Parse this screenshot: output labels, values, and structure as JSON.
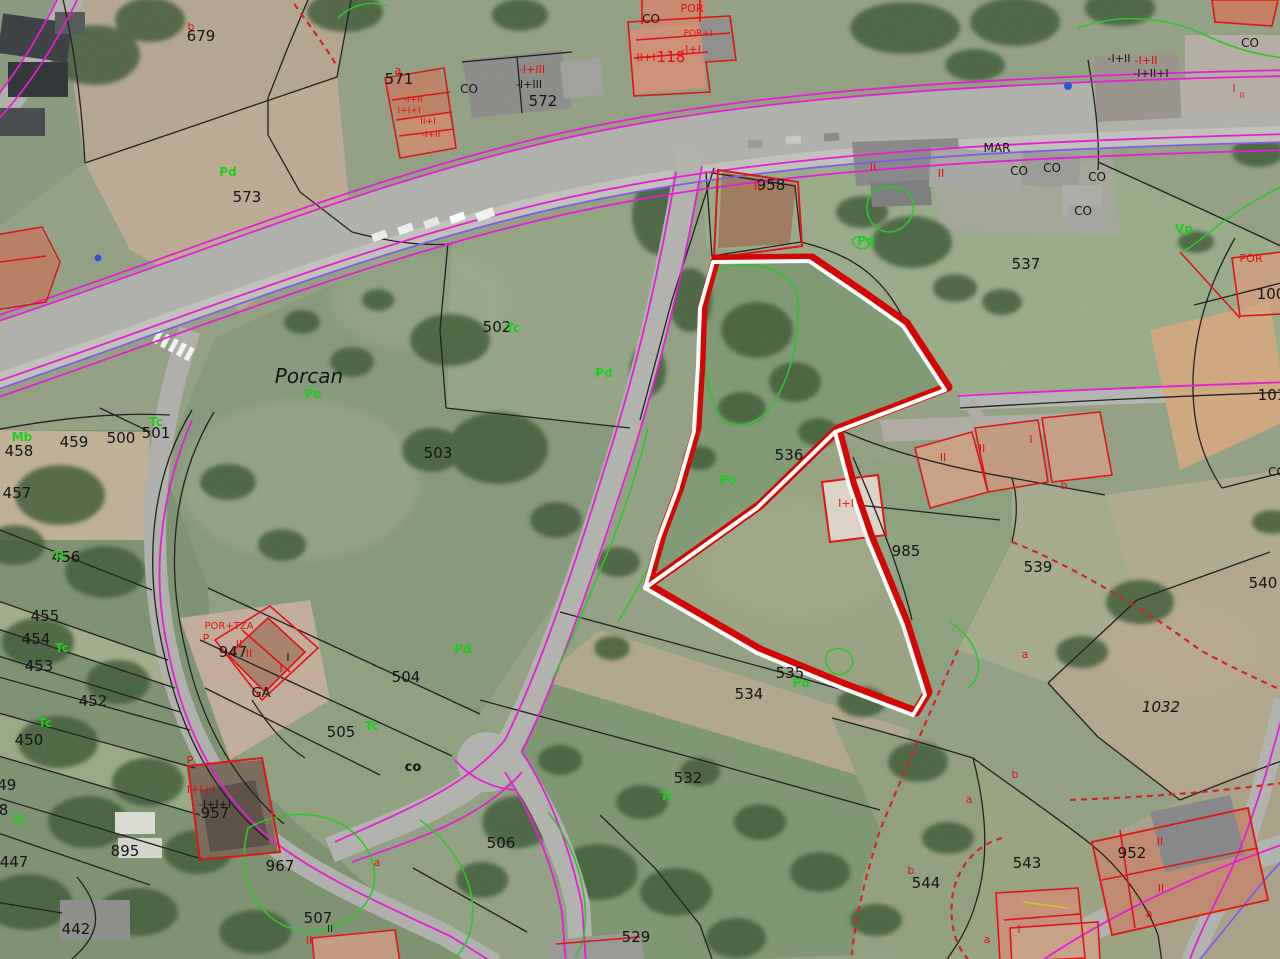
{
  "map": {
    "type": "cadastral-parcel-viewer-over-aerial-imagery",
    "place_name": "Porcan",
    "colors": {
      "parcel_boundary_black": "#1c1c1c",
      "road_edge_magenta": "#e619d6",
      "utility_purple": "#7b5be8",
      "vegetation_green": "#22cc22",
      "building_outline_red": "#e01010",
      "selection_red": "#d40000",
      "selection_white": "#ffffff"
    },
    "selection": {
      "outline": "#d40000",
      "inner_line": "#ffffff",
      "style": "thick red band with white stripe"
    },
    "labels": {
      "parcels": {
        "fill": "#141414",
        "size": 15,
        "items": [
          {
            "t": "679",
            "x": 201,
            "y": 41
          },
          {
            "t": "573",
            "x": 247,
            "y": 202
          },
          {
            "t": "571",
            "x": 399,
            "y": 84
          },
          {
            "t": "572",
            "x": 543,
            "y": 106
          },
          {
            "t": "958",
            "x": 771,
            "y": 190
          },
          {
            "t": "537",
            "x": 1026,
            "y": 269
          },
          {
            "t": "502",
            "x": 497,
            "y": 332
          },
          {
            "t": "503",
            "x": 438,
            "y": 458
          },
          {
            "t": "459",
            "x": 74,
            "y": 447
          },
          {
            "t": "458",
            "x": 19,
            "y": 456
          },
          {
            "t": "500",
            "x": 121,
            "y": 443
          },
          {
            "t": "501",
            "x": 156,
            "y": 438
          },
          {
            "t": "457",
            "x": 17,
            "y": 498
          },
          {
            "t": "456",
            "x": 66,
            "y": 562
          },
          {
            "t": "455",
            "x": 45,
            "y": 621
          },
          {
            "t": "454",
            "x": 36,
            "y": 644
          },
          {
            "t": "453",
            "x": 39,
            "y": 671
          },
          {
            "t": "452",
            "x": 93,
            "y": 706
          },
          {
            "t": "450",
            "x": 29,
            "y": 745
          },
          {
            "t": "449",
            "x": 2,
            "y": 790
          },
          {
            "t": "448",
            "x": -6,
            "y": 815
          },
          {
            "t": "447",
            "x": 14,
            "y": 867
          },
          {
            "t": "442",
            "x": 76,
            "y": 934
          },
          {
            "t": "947",
            "x": 233,
            "y": 657
          },
          {
            "t": "895",
            "x": 125,
            "y": 856
          },
          {
            "t": "957",
            "x": 215,
            "y": 818
          },
          {
            "t": "967",
            "x": 280,
            "y": 871
          },
          {
            "t": "504",
            "x": 406,
            "y": 682
          },
          {
            "t": "505",
            "x": 341,
            "y": 737
          },
          {
            "t": "506",
            "x": 501,
            "y": 848
          },
          {
            "t": "507",
            "x": 318,
            "y": 923
          },
          {
            "t": "529",
            "x": 636,
            "y": 942
          },
          {
            "t": "532",
            "x": 688,
            "y": 783
          },
          {
            "t": "534",
            "x": 749,
            "y": 699
          },
          {
            "t": "535",
            "x": 790,
            "y": 678
          },
          {
            "t": "536",
            "x": 789,
            "y": 460
          },
          {
            "t": "985",
            "x": 906,
            "y": 556
          },
          {
            "t": "539",
            "x": 1038,
            "y": 572
          },
          {
            "t": "540",
            "x": 1263,
            "y": 588
          },
          {
            "t": "1032",
            "x": 1161,
            "y": 712,
            "it": true
          },
          {
            "t": "543",
            "x": 1027,
            "y": 868
          },
          {
            "t": "544",
            "x": 926,
            "y": 888
          },
          {
            "t": "952",
            "x": 1132,
            "y": 858
          },
          {
            "t": "100",
            "x": 1271,
            "y": 299
          },
          {
            "t": "101",
            "x": 1272,
            "y": 400
          }
        ]
      },
      "codes_black": {
        "fill": "#141414",
        "size": 12,
        "items": [
          {
            "t": "Porcan",
            "x": 309,
            "y": 383,
            "fs": 20,
            "it": true
          },
          {
            "t": "MAR",
            "x": 997,
            "y": 152
          },
          {
            "t": "CO",
            "x": 469,
            "y": 93
          },
          {
            "t": "CO",
            "x": 651,
            "y": 23
          },
          {
            "t": "CO",
            "x": 1019,
            "y": 175
          },
          {
            "t": "CO",
            "x": 1052,
            "y": 172
          },
          {
            "t": "CO",
            "x": 1097,
            "y": 181
          },
          {
            "t": "CO",
            "x": 1083,
            "y": 215
          },
          {
            "t": "CO",
            "x": 1250,
            "y": 47
          },
          {
            "t": "CO",
            "x": 1277,
            "y": 476
          },
          {
            "t": "co",
            "x": 413,
            "y": 771,
            "b": true,
            "fs": 13
          },
          {
            "t": "GA",
            "x": 261,
            "y": 697,
            "fs": 13
          },
          {
            "t": "-I+III",
            "x": 529,
            "y": 88,
            "fs": 11
          },
          {
            "t": "-I+II",
            "x": 1119,
            "y": 62,
            "fs": 11
          },
          {
            "t": "-I+II+I",
            "x": 1151,
            "y": 77,
            "fs": 11
          },
          {
            "t": "-I+I+I",
            "x": 215,
            "y": 808,
            "fs": 11
          },
          {
            "t": "I",
            "x": 288,
            "y": 661,
            "fs": 11
          },
          {
            "t": "II",
            "x": 330,
            "y": 932,
            "fs": 10
          }
        ]
      },
      "codes_red": {
        "fill": "#e01010",
        "size": 11,
        "items": [
          {
            "t": "b",
            "x": 191,
            "y": 30
          },
          {
            "t": "a",
            "x": 398,
            "y": 74
          },
          {
            "t": "-I+III",
            "x": 532,
            "y": 73
          },
          {
            "t": "II+I",
            "x": 646,
            "y": 61
          },
          {
            "t": "118",
            "x": 671,
            "y": 62,
            "fs": 15
          },
          {
            "t": "-I+I",
            "x": 691,
            "y": 53
          },
          {
            "t": "POR+I",
            "x": 698,
            "y": 36,
            "fs": 9
          },
          {
            "t": "POR",
            "x": 692,
            "y": 12
          },
          {
            "t": "POR",
            "x": 1251,
            "y": 262
          },
          {
            "t": "-I+II",
            "x": 413,
            "y": 102,
            "fs": 9
          },
          {
            "t": "I+I+I",
            "x": 409,
            "y": 113,
            "fs": 9
          },
          {
            "t": "II+I",
            "x": 428,
            "y": 124,
            "fs": 9
          },
          {
            "t": "-I+II",
            "x": 431,
            "y": 137,
            "fs": 9
          },
          {
            "t": "II",
            "x": 757,
            "y": 190
          },
          {
            "t": "II",
            "x": 873,
            "y": 171
          },
          {
            "t": "II",
            "x": 941,
            "y": 177
          },
          {
            "t": "-I+II",
            "x": 1146,
            "y": 64
          },
          {
            "t": "I",
            "x": 1234,
            "y": 92
          },
          {
            "t": "II",
            "x": 1242,
            "y": 98,
            "fs": 8
          },
          {
            "t": "POR+TZA",
            "x": 229,
            "y": 629,
            "fs": 10
          },
          {
            "t": "P",
            "x": 206,
            "y": 642
          },
          {
            "t": "II",
            "x": 239,
            "y": 648
          },
          {
            "t": "II",
            "x": 249,
            "y": 657
          },
          {
            "t": "I",
            "x": 281,
            "y": 672
          },
          {
            "t": "P",
            "x": 190,
            "y": 764
          },
          {
            "t": "I+I+I",
            "x": 201,
            "y": 793
          },
          {
            "t": "a",
            "x": 377,
            "y": 866
          },
          {
            "t": "II",
            "x": 309,
            "y": 944
          },
          {
            "t": "II",
            "x": 943,
            "y": 461
          },
          {
            "t": "II",
            "x": 982,
            "y": 452
          },
          {
            "t": "I",
            "x": 1031,
            "y": 443
          },
          {
            "t": "b",
            "x": 1064,
            "y": 489
          },
          {
            "t": "I+I",
            "x": 846,
            "y": 507
          },
          {
            "t": "a",
            "x": 1025,
            "y": 658
          },
          {
            "t": "b",
            "x": 1015,
            "y": 778
          },
          {
            "t": "a",
            "x": 969,
            "y": 803
          },
          {
            "t": "b",
            "x": 911,
            "y": 874
          },
          {
            "t": "a",
            "x": 987,
            "y": 943
          },
          {
            "t": "I",
            "x": 1019,
            "y": 933
          },
          {
            "t": "II",
            "x": 1160,
            "y": 845
          },
          {
            "t": "II",
            "x": 1161,
            "y": 892
          },
          {
            "t": "a",
            "x": 1149,
            "y": 917
          }
        ]
      },
      "land_use": {
        "fill": "#21cc21",
        "size": 12,
        "bold": true,
        "items": [
          {
            "t": "Pd",
            "x": 228,
            "y": 176
          },
          {
            "t": "Po",
            "x": 313,
            "y": 398
          },
          {
            "t": "Tc",
            "x": 513,
            "y": 332
          },
          {
            "t": "Pd",
            "x": 604,
            "y": 377
          },
          {
            "t": "Pd",
            "x": 866,
            "y": 245
          },
          {
            "t": "Vp",
            "x": 1184,
            "y": 233
          },
          {
            "t": "Mb",
            "x": 22,
            "y": 441
          },
          {
            "t": "Tc",
            "x": 156,
            "y": 426
          },
          {
            "t": "Tc",
            "x": 60,
            "y": 560
          },
          {
            "t": "Tc",
            "x": 62,
            "y": 652
          },
          {
            "t": "Tc",
            "x": 45,
            "y": 727
          },
          {
            "t": "Tc",
            "x": 19,
            "y": 824
          },
          {
            "t": "Tc",
            "x": 372,
            "y": 730
          },
          {
            "t": "Pd",
            "x": 463,
            "y": 653
          },
          {
            "t": "Po",
            "x": 728,
            "y": 484
          },
          {
            "t": "Po",
            "x": 801,
            "y": 687
          },
          {
            "t": "Tc",
            "x": 667,
            "y": 800
          }
        ]
      }
    }
  }
}
